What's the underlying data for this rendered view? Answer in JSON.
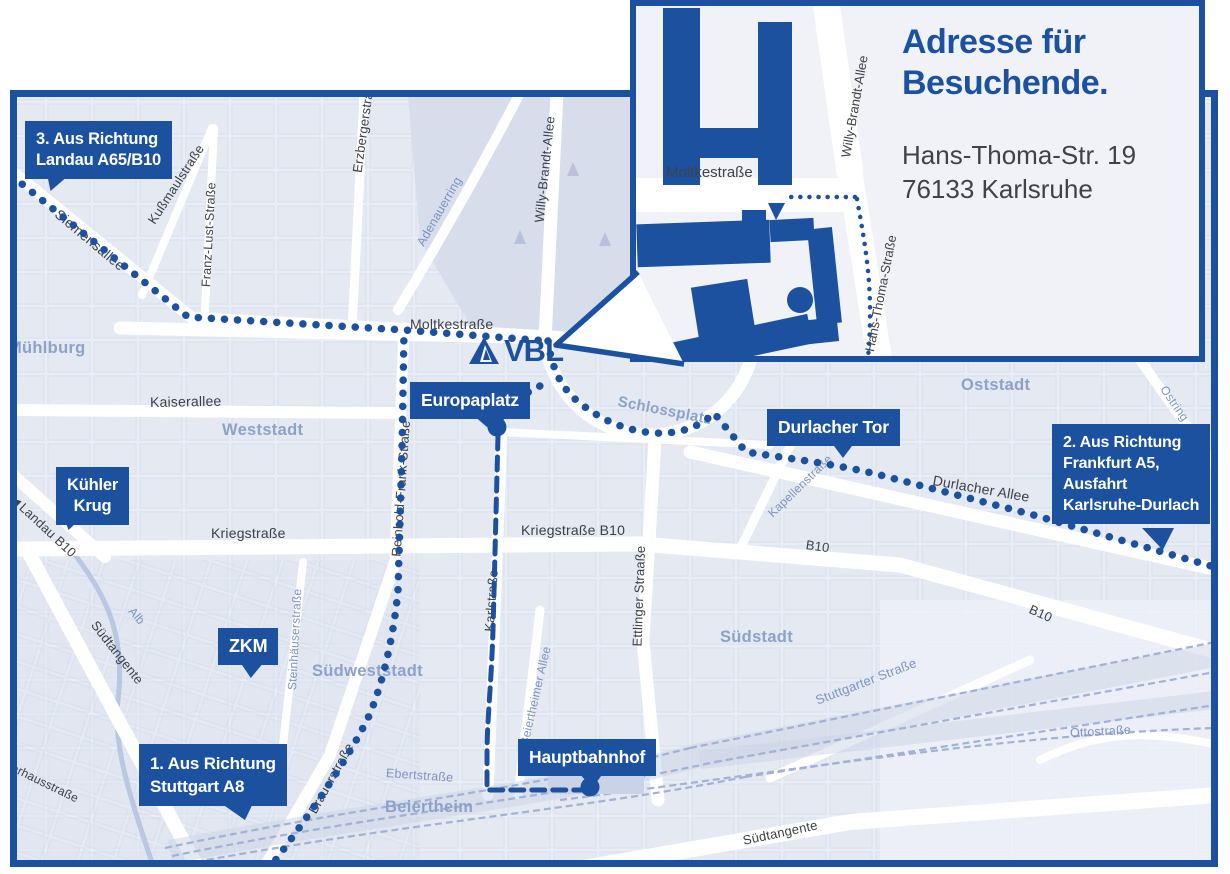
{
  "map": {
    "colors": {
      "primary_blue": "#1b519f",
      "map_background": "#e9edf5",
      "area_label": "#8da1c9"
    },
    "logo": {
      "text": "VBL"
    },
    "inset": {
      "title_line1": "Adresse für",
      "title_line2": "Besuchende.",
      "address_line1": "Hans-Thoma-Str. 19",
      "address_line2": "76133 Karlsruhe",
      "street_moltke": "Moltkestraße",
      "street_willy": "Willy-Brandt-Allee",
      "street_hansthoma": "Hans-Thoma-Straße"
    },
    "callouts": {
      "landau": {
        "line1": "3. Aus Richtung",
        "line2": "Landau A65/B10"
      },
      "frankfurt": {
        "line1": "2. Aus Richtung",
        "line2": "Frankfurt A5,",
        "line3": "Ausfahrt",
        "line4": "Karlsruhe-Durlach"
      },
      "stuttgart": {
        "line1": "1. Aus Richtung",
        "line2": "Stuttgart A8"
      },
      "europaplatz": {
        "label": "Europaplatz"
      },
      "durlacher_tor": {
        "label": "Durlacher Tor"
      },
      "kuehler_krug": {
        "line1": "Kühler",
        "line2": "Krug"
      },
      "zkm": {
        "label": "ZKM"
      },
      "hauptbahnhof": {
        "label": "Hauptbahnhof"
      }
    },
    "area_labels": [
      {
        "label": "Mühlburg",
        "x": 8,
        "y": 355,
        "rot": 0,
        "s": 16.5
      },
      {
        "label": "Weststadt",
        "x": 222,
        "y": 437,
        "rot": 0,
        "s": 16.5
      },
      {
        "label": "Südweststadt",
        "x": 312,
        "y": 678,
        "rot": 0,
        "s": 16.5
      },
      {
        "label": "Südstadt",
        "x": 720,
        "y": 644,
        "rot": 0,
        "s": 16.5
      },
      {
        "label": "Oststadt",
        "x": 961,
        "y": 392,
        "rot": 0,
        "s": 16.5
      },
      {
        "label": "Beiertheim",
        "x": 385,
        "y": 814,
        "rot": 0,
        "s": 16.5
      },
      {
        "label": "Schlossplatz",
        "x": 618,
        "y": 408,
        "rot": 11,
        "s": 15
      }
    ],
    "street_labels": [
      {
        "label": "Siemensallee",
        "x": 57,
        "y": 218,
        "rot": 40,
        "c": "dark",
        "s": 14
      },
      {
        "label": "Kußmaulstraße",
        "x": 151,
        "y": 228,
        "rot": -57,
        "c": "dark",
        "s": 13
      },
      {
        "label": "Franz-Lust-Straße",
        "x": 206,
        "y": 292,
        "rot": -87,
        "c": "dark",
        "s": 12.5
      },
      {
        "label": "Erzbergerstraße",
        "x": 357,
        "y": 178,
        "rot": -82,
        "c": "dark",
        "s": 13
      },
      {
        "label": "Willy-Brandt-Allee",
        "x": 539,
        "y": 228,
        "rot": -84,
        "c": "dark",
        "s": 13
      },
      {
        "label": "Moltkestraße",
        "x": 410,
        "y": 330,
        "rot": 0,
        "c": "dark",
        "s": 14
      },
      {
        "label": "Kaiserallee",
        "x": 150,
        "y": 408,
        "rot": -1,
        "c": "dark",
        "s": 14
      },
      {
        "label": "Kriegstraße",
        "x": 211,
        "y": 539,
        "rot": 0,
        "c": "dark",
        "s": 14
      },
      {
        "label": "Kriegstraße B10",
        "x": 521,
        "y": 536,
        "rot": 0,
        "c": "dark",
        "s": 14
      },
      {
        "label": "Karlstraße",
        "x": 489,
        "y": 637,
        "rot": -86,
        "c": "dark",
        "s": 13
      },
      {
        "label": "Ettlinger Straaße",
        "x": 637,
        "y": 652,
        "rot": -88,
        "c": "dark",
        "s": 13
      },
      {
        "label": "Reinhold-Frank-Straße",
        "x": 396,
        "y": 562,
        "rot": -86,
        "c": "dark",
        "s": 13
      },
      {
        "label": "Durlacher Allee",
        "x": 933,
        "y": 486,
        "rot": 10,
        "c": "dark",
        "s": 14
      },
      {
        "label": "B10",
        "x": 806,
        "y": 550,
        "rot": 8,
        "c": "dark",
        "s": 13
      },
      {
        "label": "B10",
        "x": 1030,
        "y": 614,
        "rot": 24,
        "c": "dark",
        "s": 13
      },
      {
        "label": "Südtangente",
        "x": 94,
        "y": 628,
        "rot": 52,
        "c": "dark",
        "s": 13
      },
      {
        "label": "Südtangente",
        "x": 743,
        "y": 846,
        "rot": -12,
        "c": "dark",
        "s": 13
      },
      {
        "label": "Brauerstraße",
        "x": 312,
        "y": 818,
        "rot": -61,
        "c": "dark",
        "s": 13
      },
      {
        "label": "lverhausstraße",
        "x": 4,
        "y": 768,
        "rot": 26,
        "c": "dark",
        "s": 12
      },
      {
        "label": "◄Landau B10",
        "x": 12,
        "y": 502,
        "rot": 43,
        "c": "dark",
        "s": 13
      },
      {
        "label": "Ebertstraße",
        "x": 386,
        "y": 778,
        "rot": 4,
        "c": "blue",
        "s": 12.5
      },
      {
        "label": "Adenauerring",
        "x": 420,
        "y": 250,
        "rot": -60,
        "c": "blue",
        "s": 12.5
      },
      {
        "label": "Kapellenstraße",
        "x": 770,
        "y": 520,
        "rot": -44,
        "c": "blue",
        "s": 12
      },
      {
        "label": "Steinhäuserstraße",
        "x": 292,
        "y": 695,
        "rot": -87,
        "c": "blue",
        "s": 12
      },
      {
        "label": "Beiertheimer Allee",
        "x": 524,
        "y": 750,
        "rot": -77,
        "c": "blue",
        "s": 12
      },
      {
        "label": "Stuttgarter Straße",
        "x": 816,
        "y": 706,
        "rot": -21,
        "c": "blue",
        "s": 13
      },
      {
        "label": "Ostring",
        "x": 1163,
        "y": 392,
        "rot": 55,
        "c": "blue",
        "s": 12
      },
      {
        "label": "Ostring",
        "x": 1176,
        "y": 492,
        "rot": 60,
        "c": "blue",
        "s": 12
      },
      {
        "label": "Ottostraße",
        "x": 1070,
        "y": 738,
        "rot": -3,
        "c": "blue",
        "s": 12.5
      },
      {
        "label": "Alb",
        "x": 131,
        "y": 614,
        "rot": 50,
        "c": "blue",
        "s": 12
      }
    ]
  }
}
